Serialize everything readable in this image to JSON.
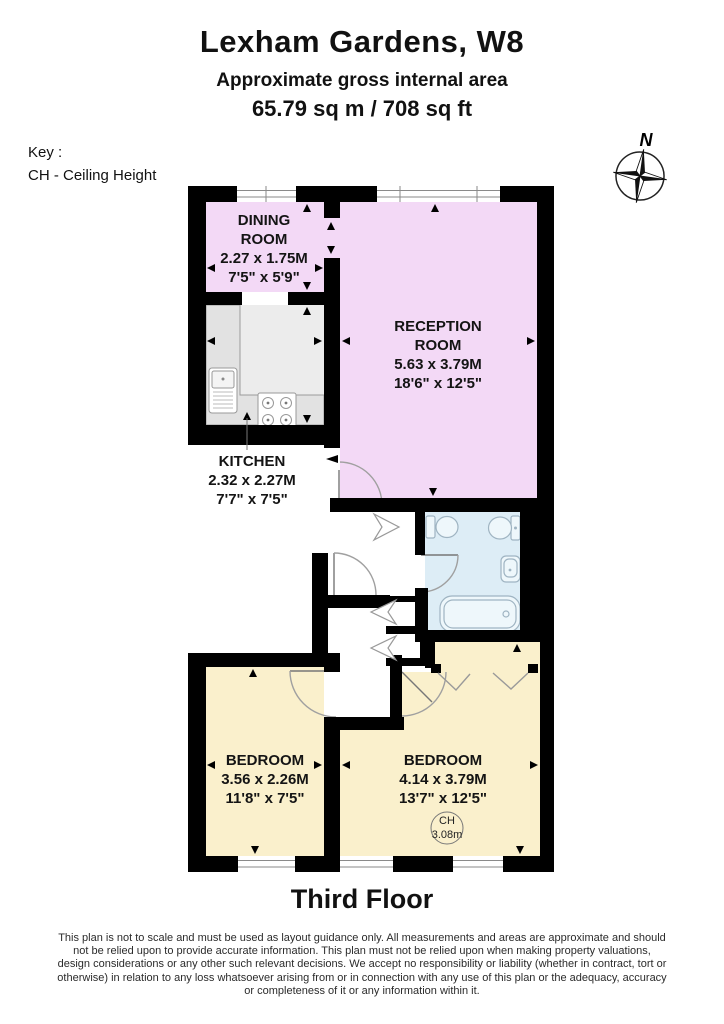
{
  "header": {
    "title": "Lexham Gardens, W8",
    "subtitle": "Approximate gross internal area",
    "area_line": "65.79 sq m / 708 sq ft"
  },
  "key": {
    "heading": "Key :",
    "ceiling_height_entry": "CH - Ceiling Height"
  },
  "compass": {
    "north_label": "N"
  },
  "plan": {
    "floor_label": "Third Floor",
    "rooms": [
      {
        "id": "dining-room",
        "lines": [
          "DINING",
          "ROOM",
          "2.27 x 1.75M",
          "7'5\" x 5'9\""
        ]
      },
      {
        "id": "reception-room",
        "lines": [
          "RECEPTION",
          "ROOM",
          "5.63 x 3.79M",
          "18'6\" x 12'5\""
        ]
      },
      {
        "id": "kitchen",
        "lines": [
          "KITCHEN",
          "2.32 x 2.27M",
          "7'7\" x 7'5\""
        ]
      },
      {
        "id": "bedroom-left",
        "lines": [
          "BEDROOM",
          "3.56 x 2.26M",
          "11'8\" x 7'5\""
        ]
      },
      {
        "id": "bedroom-right",
        "lines": [
          "BEDROOM",
          "4.14 x 3.79M",
          "13'7\" x 12'5\""
        ],
        "ceiling_height": {
          "label": "CH",
          "value": "3.08m"
        }
      }
    ],
    "colors": {
      "room_pink": "#f3d9f6",
      "bathroom_blue": "#ddedf6",
      "bedroom_cream": "#faf0cc",
      "kitchen_floor_grey": "#ececec",
      "kitchen_counter_grey": "#e2e2e2",
      "wall_black": "#000000"
    }
  },
  "disclaimer": {
    "lines": [
      "This plan is not to scale and must be used as layout guidance only. All measurements and areas are approximate and should",
      "not be relied upon to provide accurate information. This plan must not be relied upon when making property valuations,",
      "design considerations or any other such relevant decisions. We accept no responsibility or liability (whether in contract, tort or",
      "otherwise) in relation to any loss whatsoever arising from or in connection with any use of this plan or the adequacy, accuracy",
      "or completeness of it or any information within it."
    ]
  }
}
